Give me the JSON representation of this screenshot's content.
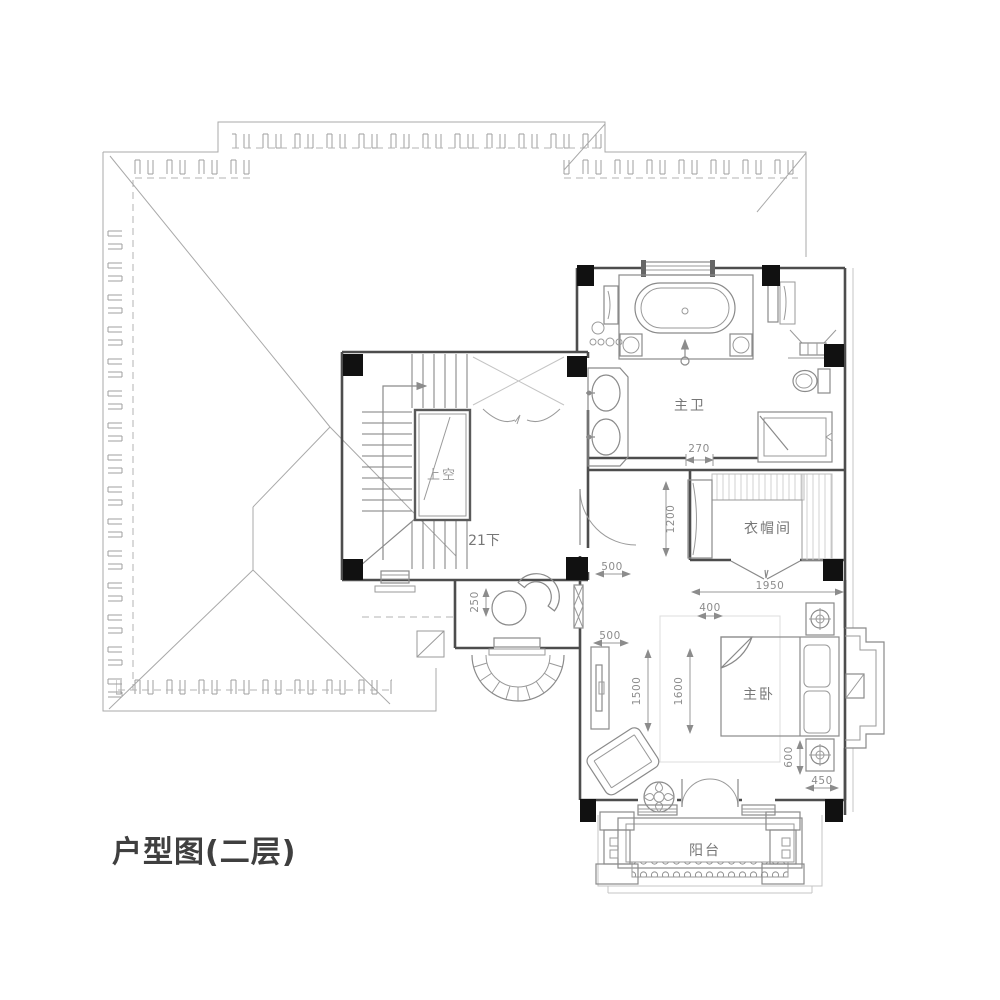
{
  "title": "户型图(二层)",
  "colors": {
    "background": "#ffffff",
    "roof_line": "#a9a9a9",
    "wall_line": "#4d4d4d",
    "column_fill": "#111111",
    "fixture_line": "#8a8a8a",
    "room_label": "#767676",
    "void_label": "#9b9b9b",
    "dimension_label": "#8c8c8c",
    "title_color": "#3f3f3f"
  },
  "rooms": {
    "void": {
      "label": "上空"
    },
    "stairs": {
      "label": "21下"
    },
    "master_bath": {
      "label": "主卫"
    },
    "cloakroom": {
      "label": "衣帽间"
    },
    "master_bedroom": {
      "label": "主卧"
    },
    "balcony": {
      "label": "阳台"
    }
  },
  "dimensions": {
    "bath_opening": "270",
    "cloak_cabinet": "1200",
    "cloak_width": "1950",
    "corridor_window_upper": "500",
    "nook_depth": "250",
    "corridor_window_lower": "500",
    "bed_gap": "400",
    "tv_wall": "1500",
    "bed_width": "1600",
    "bed_side": "600",
    "corner_offset": "450"
  }
}
